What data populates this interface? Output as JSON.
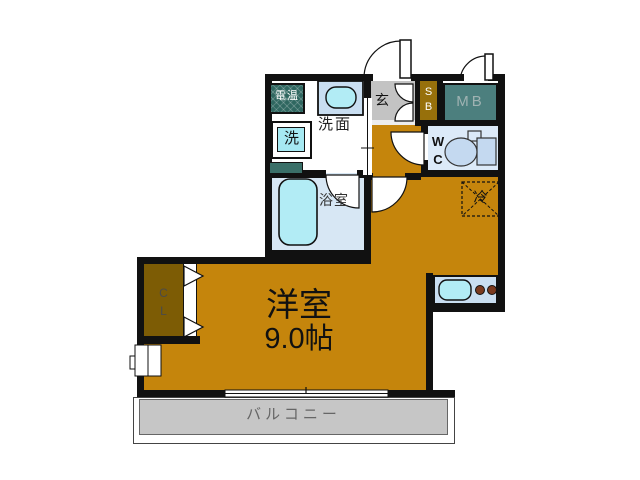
{
  "unit": {
    "main_room": {
      "name": "洋室",
      "area": "9.0帖"
    },
    "balcony": {
      "label": "バルコニー"
    },
    "washroom": {
      "label": "洗面"
    },
    "bathroom": {
      "label": "浴室"
    },
    "entrance": {
      "label": "玄"
    },
    "toilet_room": {
      "label": "W\nC"
    },
    "shoe_box": {
      "label": "S\nB"
    },
    "meter_box": {
      "label": "MB"
    },
    "closet": {
      "label": "C\nL"
    },
    "water_heater": {
      "label": "電温"
    },
    "washing_machine": {
      "label": "洗"
    },
    "refrigerator": {
      "label": "冷"
    }
  },
  "colors": {
    "floor": "#C5850C",
    "closet": "#7D5C05",
    "shoe_box": "#97700B",
    "meter_box": "#4C7F7E",
    "water_heater": "#2F6760",
    "balcony": "#C6C6C6",
    "entrance_floor": "#C3C3C3",
    "bathroom": "#D7E7F4",
    "toilet_room": "#DCEAF8",
    "fixture_cyan": "#B2ECF5",
    "counter_blue": "#C9DEF1",
    "wall": "#111111"
  }
}
